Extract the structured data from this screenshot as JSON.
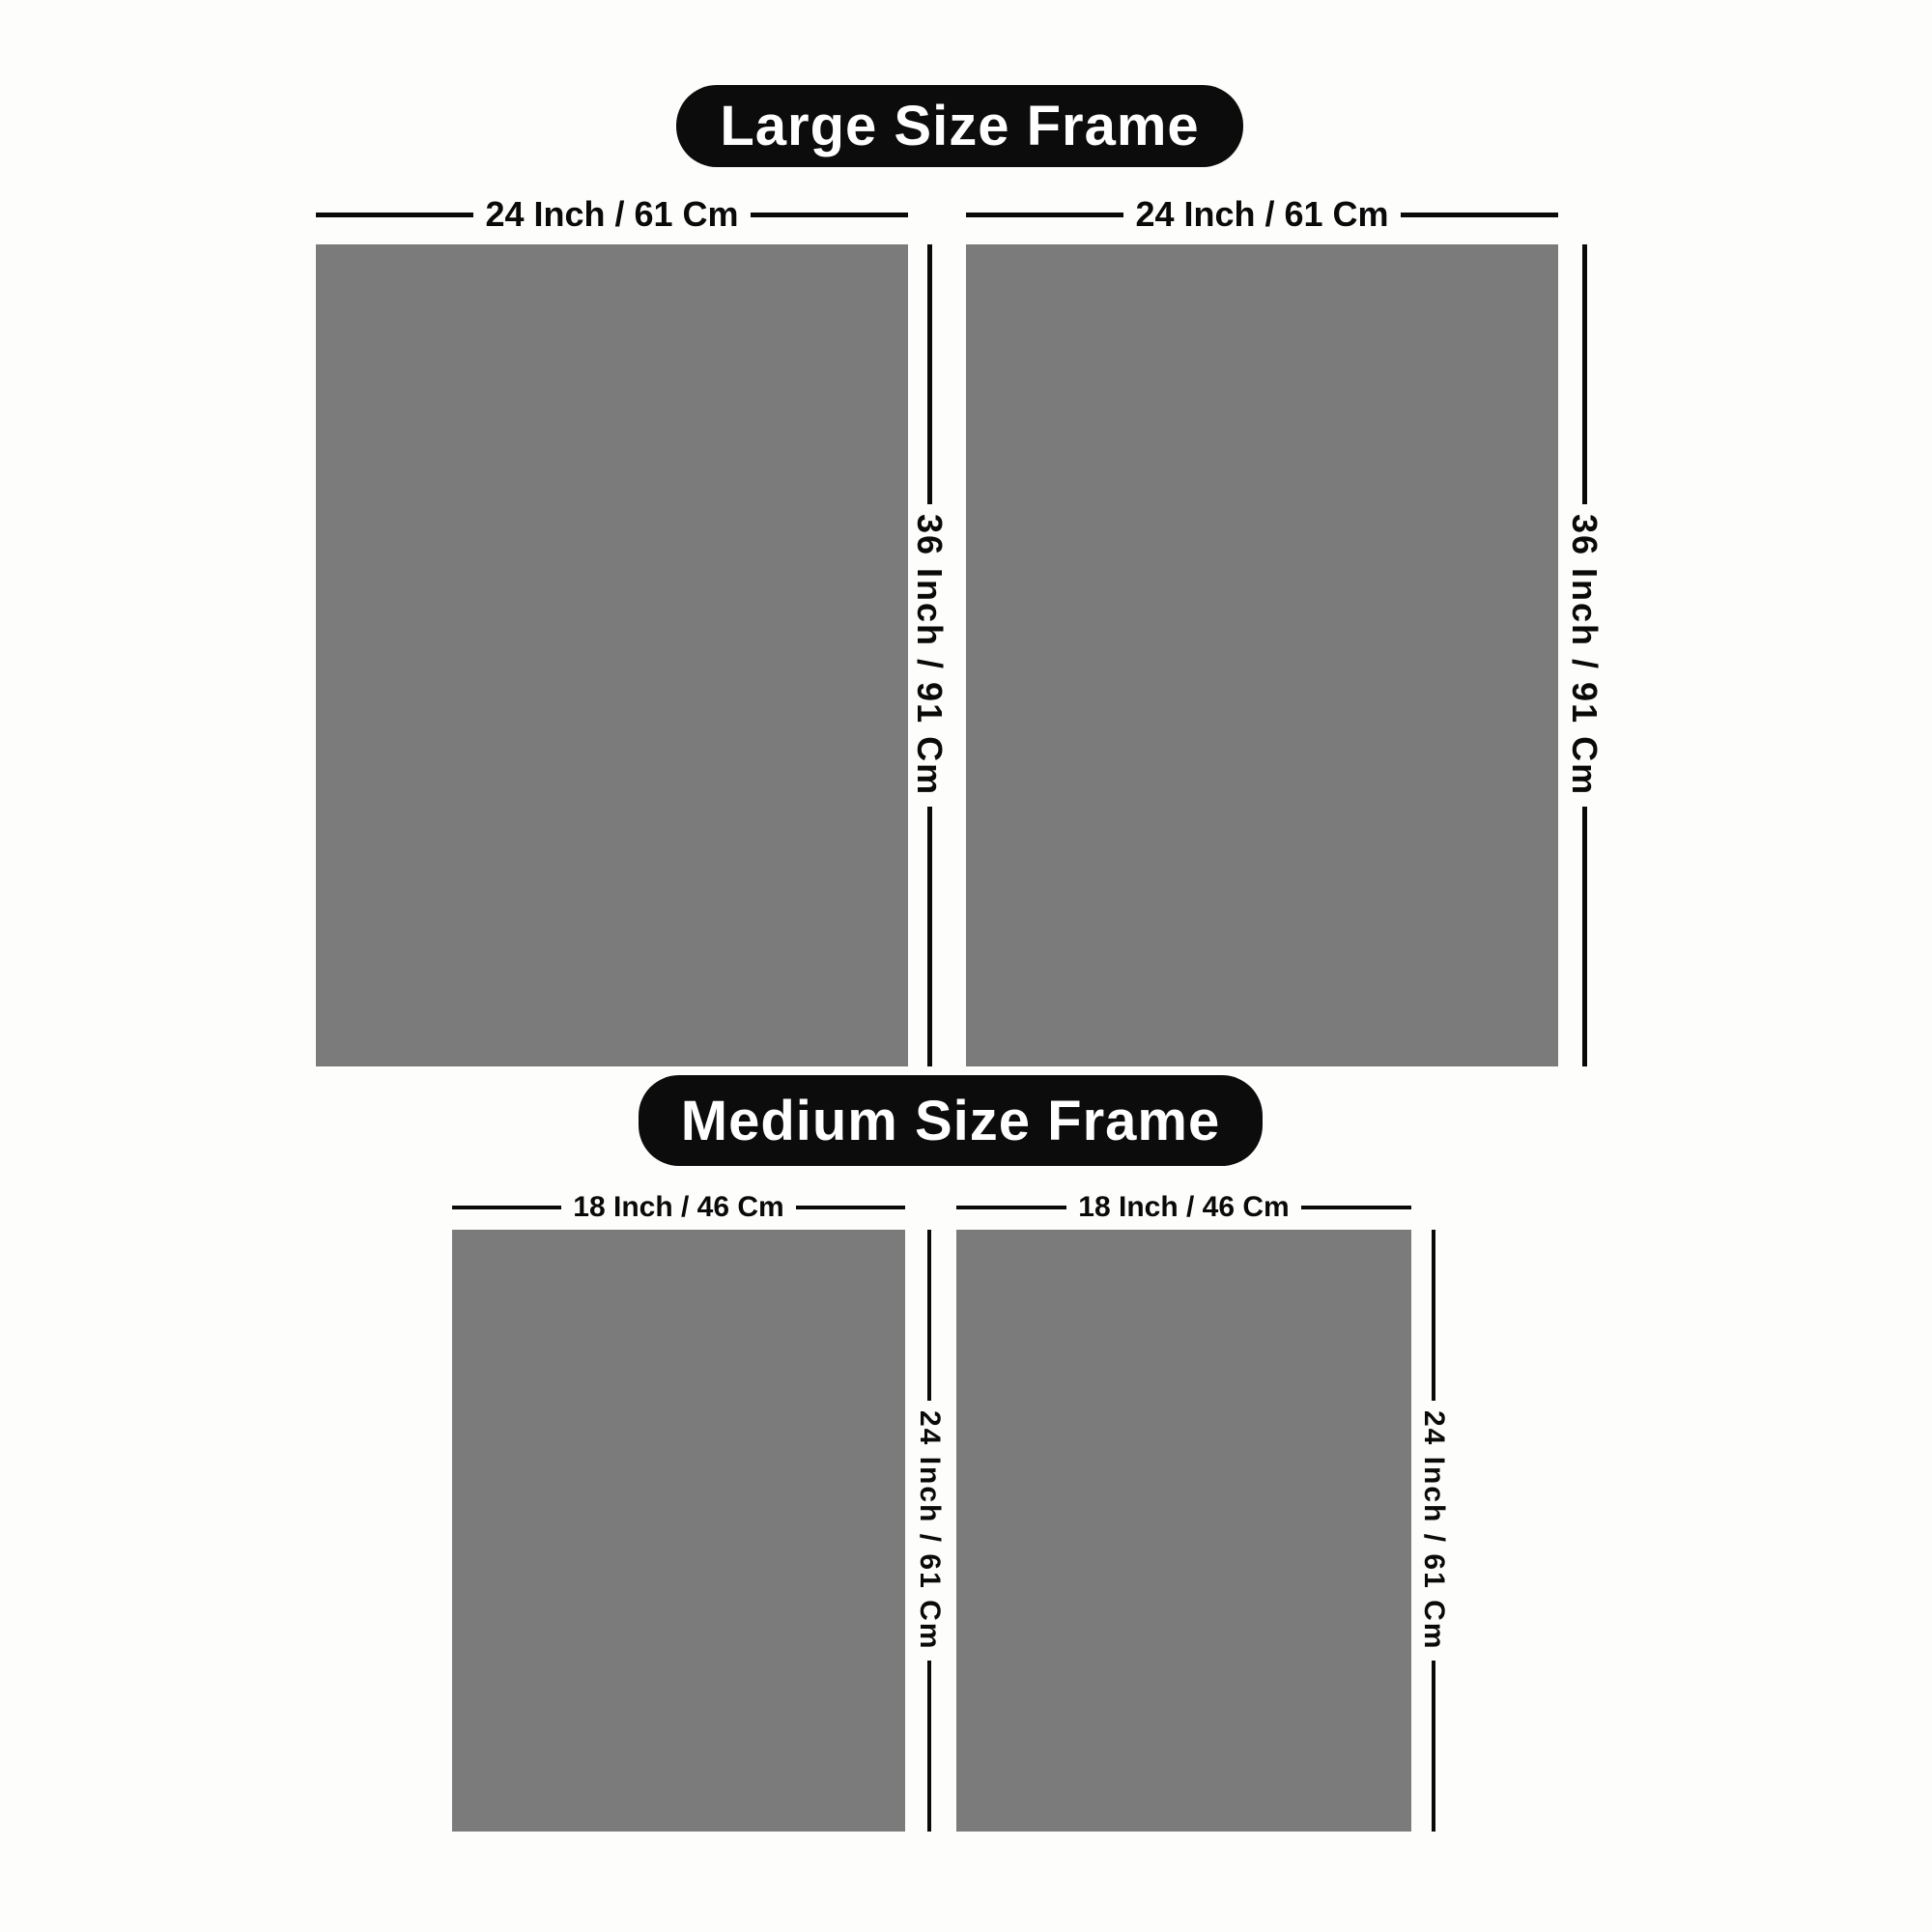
{
  "colors": {
    "background": "#fdfdfb",
    "pill_background": "#0c0c0c",
    "pill_text": "#ffffff",
    "frame_fill": "#7b7b7b",
    "dimension_line": "#0a0a0a",
    "dimension_text": "#0a0a0a"
  },
  "sections": [
    {
      "id": "large",
      "title": "Large Size Frame",
      "frames": [
        {
          "width_label": "24 Inch / 61 Cm",
          "height_label": "36 Inch / 91 Cm"
        },
        {
          "width_label": "24 Inch / 61 Cm",
          "height_label": "36 Inch / 91 Cm"
        }
      ]
    },
    {
      "id": "medium",
      "title": "Medium Size Frame",
      "frames": [
        {
          "width_label": "18 Inch / 46 Cm",
          "height_label": "24 Inch / 61 Cm"
        },
        {
          "width_label": "18 Inch / 46 Cm",
          "height_label": "24 Inch / 61 Cm"
        }
      ]
    }
  ]
}
